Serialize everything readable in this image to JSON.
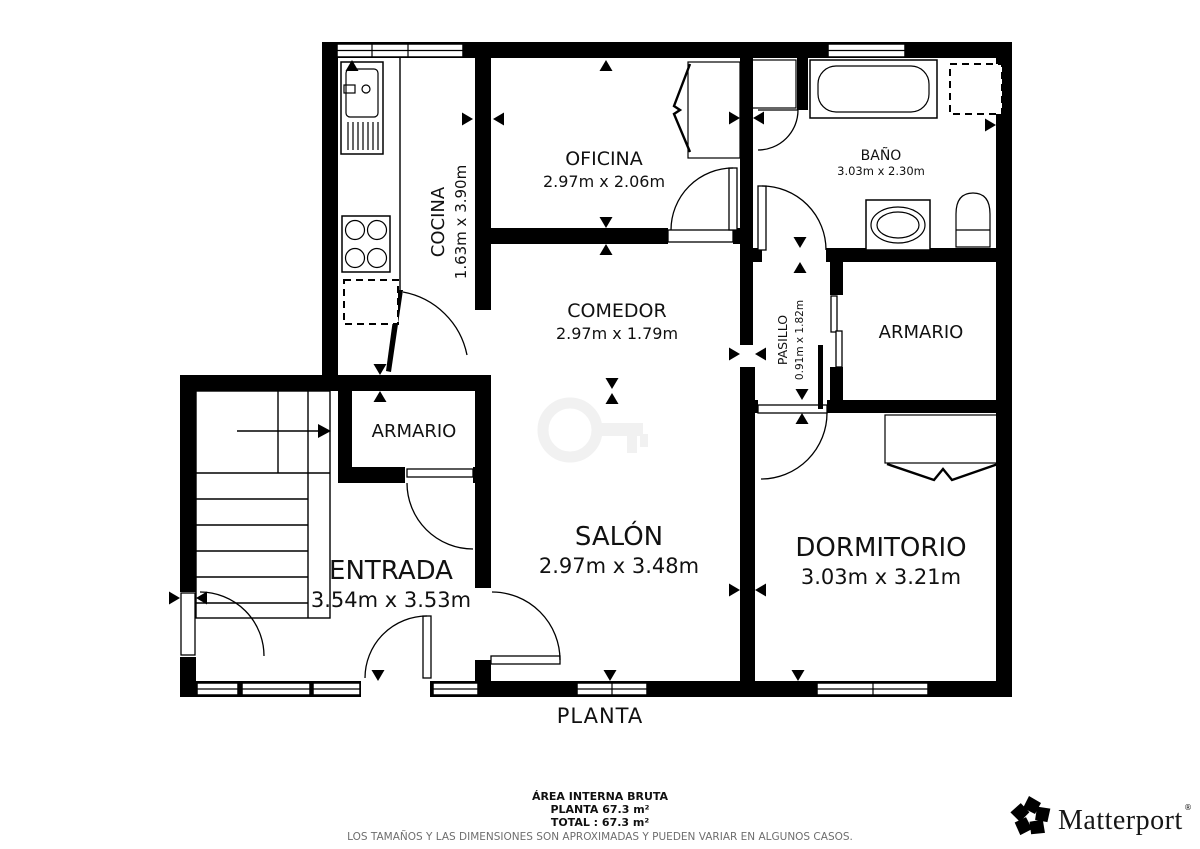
{
  "colors": {
    "wall": "#000000",
    "background": "#ffffff",
    "watermark": "#f1f1f1",
    "disclaimer_text": "#6e6e6e"
  },
  "plan": {
    "floor_title": "PLANTA",
    "rooms": {
      "cocina": {
        "name": "COCINA",
        "dims": "1.63m x 3.90m"
      },
      "oficina": {
        "name": "OFICINA",
        "dims": "2.97m x 2.06m"
      },
      "bano": {
        "name": "BAÑO",
        "dims": "3.03m x 2.30m"
      },
      "comedor": {
        "name": "COMEDOR",
        "dims": "2.97m x 1.79m"
      },
      "pasillo": {
        "name": "PASILLO",
        "dims": "0.91m x 1.82m"
      },
      "armario_izq": {
        "name": "ARMARIO"
      },
      "armario_der": {
        "name": "ARMARIO"
      },
      "entrada": {
        "name": "ENTRADA",
        "dims": "3.54m x 3.53m"
      },
      "salon": {
        "name": "SALÓN",
        "dims": "2.97m x 3.48m"
      },
      "dormitorio": {
        "name": "DORMITORIO",
        "dims": "3.03m x 3.21m"
      }
    }
  },
  "footer": {
    "area_heading": "ÁREA INTERNA BRUTA",
    "planta_area": "PLANTA 67.3 m²",
    "total_area": "TOTAL :  67.3 m²",
    "disclaimer": "LOS TAMAÑOS Y LAS DIMENSIONES SON APROXIMADAS Y PUEDEN VARIAR EN ALGUNOS CASOS."
  },
  "brand": {
    "name": "Matterport",
    "mark": "®"
  }
}
